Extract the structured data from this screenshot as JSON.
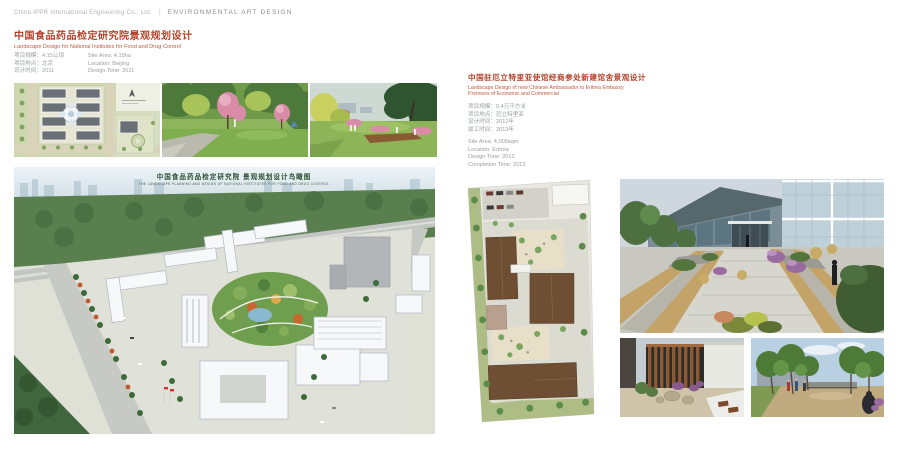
{
  "header": {
    "company": "China IPPR International Engineering Co., Ltd.",
    "divider": "|",
    "section": "ENVIRONMENTAL ART DESIGN"
  },
  "left_project": {
    "title_zh": "中国食品药品检定研究院景观规划设计",
    "title_en": "Landscape Design for National Institutes for Food and Drug Control",
    "info_zh": [
      "项目规模：4.15公顷",
      "项目地点：北京",
      "设计时间：2011"
    ],
    "info_en": [
      "Site Area: 4.15ha",
      "Location: Beijing",
      "Design Time: 2011"
    ],
    "aerial_caption_zh": "中国食品药品检定研究院 景观规划设计鸟瞰图",
    "aerial_caption_en": "THE LANDSCAPE PLANNING AND DESIGN OF NATIONAL INSTITUTES FOR FOOD AND DRUG CONTROL"
  },
  "right_project": {
    "title_zh": "中国驻厄立特里亚使馆经商参处新建馆舍景观设计",
    "title_en_line1": "Landscape Design of new Chinese Ambassador to Eritrea Embassy",
    "title_en_line2": "Premises of Economic and Commercial",
    "info_zh": [
      "项目规模：0.4万平方米",
      "项目地点：厄立特里亚",
      "设计时间：2012年",
      "竣工时间：2013年"
    ],
    "info_en": [
      "Site Area: 4,000sqm",
      "Location: Eritrea",
      "Design Time: 2012",
      "Completion Time: 2013"
    ]
  },
  "colors": {
    "accent_red": "#b5442c",
    "text_gray": "#9a9da0",
    "caption_green": "#2d4f33"
  }
}
